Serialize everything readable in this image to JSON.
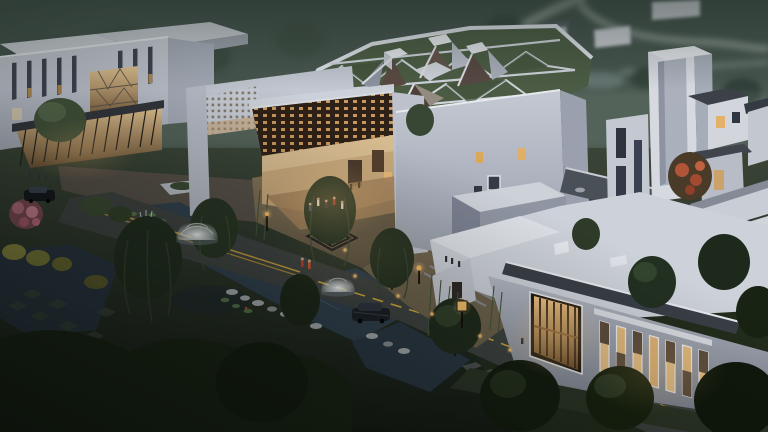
{
  "scene": {
    "type": "architectural-rendering",
    "time_of_day": "dusk",
    "description": "Aerial dusk rendering of a white modernist cultural complex with a triangulated green roof topped by faceted crystal skylights, perforated brick screens, a tall tower, courtyards with dome fountains and a square spiral water maze, willow trees, bamboo, ponds with lily pads and rocks, roads with yellow centerlines, parked cars and small groups of pedestrians",
    "objects": [
      "background-river-landscape",
      "left-gallery-building",
      "lattice-screen-pavilion",
      "triangulated-green-roof",
      "crystal-skylights",
      "exhibition-hall",
      "tower",
      "courtyard-houses",
      "entrance-hall-with-lit-windows",
      "spiral-maze-water-feature",
      "dome-fountains",
      "willow-trees",
      "blossom-tree",
      "autumn-red-tree",
      "water-channel-and-ponds",
      "plaza",
      "road-with-yellow-centerline",
      "pedestrians",
      "parked-cars",
      "street-lamps-and-bollards"
    ]
  },
  "palette": {
    "sky_top": "#44534c",
    "sky_bottom": "#607068",
    "building_light": "#d6d9e0",
    "building_mid": "#b3b8c4",
    "building_shadow": "#8f95a2",
    "roof_green": "#4c5c44",
    "warm_light": "#f0c586",
    "lattice_brown": "#c8985c",
    "water": "#32414f",
    "ground_dark": "#161c15",
    "plaza_warm": "#87765a",
    "road": "#3f4341",
    "road_line_yellow": "#d2a93e",
    "tree_dark": "#1a2415",
    "tree_light": "#49593c",
    "blossom_pink": "#b06a78",
    "autumn_red": "#b05538"
  }
}
